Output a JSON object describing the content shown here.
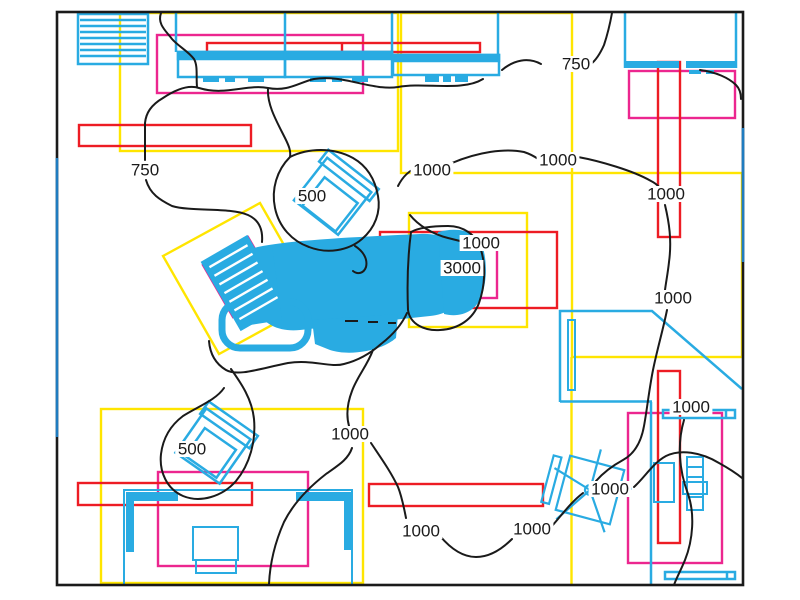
{
  "drawing": {
    "kind": "floor-plan-with-isolux-contours",
    "colors": {
      "furniture_cyan": "#29ABE2",
      "border_blue_overlay": "#1F7CC0",
      "zone_red": "#ED1C24",
      "zone_magenta": "#EC268F",
      "zone_yellow": "#FFE500",
      "contour_black": "#1A1A1A",
      "background": "#FFFFFF"
    },
    "objects": [
      "storage-shelf",
      "wall-counter",
      "wall-counter",
      "wall-counter",
      "corner-counter",
      "stool",
      "dental-chair",
      "cabinet",
      "office-chair",
      "stool",
      "desk",
      "monitor-table",
      "equipment-cart",
      "wall-bar",
      "wall-bar"
    ]
  },
  "contour_labels": [
    {
      "text": "750",
      "x": 576,
      "y": 64
    },
    {
      "text": "750",
      "x": 145,
      "y": 170
    },
    {
      "text": "1000",
      "x": 432,
      "y": 170
    },
    {
      "text": "1000",
      "x": 558,
      "y": 160
    },
    {
      "text": "500",
      "x": 312,
      "y": 196
    },
    {
      "text": "1000",
      "x": 481,
      "y": 243
    },
    {
      "text": "3000",
      "x": 462,
      "y": 268
    },
    {
      "text": "1000",
      "x": 666,
      "y": 194
    },
    {
      "text": "1000",
      "x": 673,
      "y": 298
    },
    {
      "text": "1000",
      "x": 691,
      "y": 407
    },
    {
      "text": "500",
      "x": 192,
      "y": 449
    },
    {
      "text": "1000",
      "x": 350,
      "y": 434
    },
    {
      "text": "1000",
      "x": 421,
      "y": 531
    },
    {
      "text": "1000",
      "x": 532,
      "y": 529
    },
    {
      "text": "1000",
      "x": 610,
      "y": 489
    }
  ]
}
